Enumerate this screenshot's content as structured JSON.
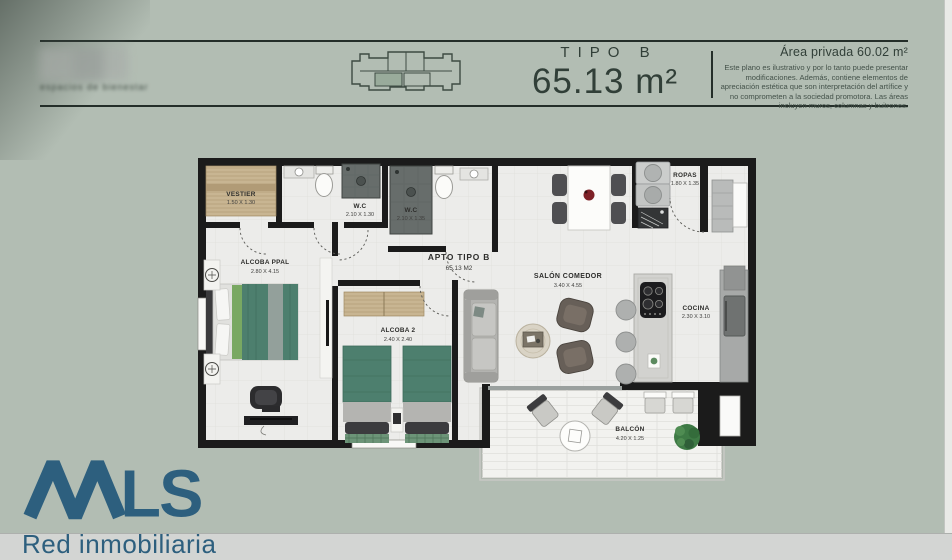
{
  "colors": {
    "background": "#b2bdb3",
    "wall": "#1b1b1b",
    "brand_blue": "#2d5f7e",
    "furniture_teal": "#4d7f6e",
    "header_text": "#313f38"
  },
  "header": {
    "project_tagline": "espacios de bienestar",
    "type_label": "TIPO B",
    "area_value": "65.13 m²",
    "private_area": "Área privada 60.02 m²",
    "disclaimer": "Este plano es ilustrativo y por lo tanto puede presentar modificaciones. Además, contiene elementos de apreciación estética que son interpretación del artífice y no comprometen a la sociedad promotora. Las áreas incluyen muros, columnas y buitrones."
  },
  "plan": {
    "unit_name": "APTO TIPO B",
    "unit_area": "65.13 M2",
    "rooms": {
      "vestier": {
        "name": "VESTIER",
        "dims": "1.50 X 1.30"
      },
      "wc1": {
        "name": "W.C",
        "dims": "2.10 X 1.30"
      },
      "wc2": {
        "name": "W.C",
        "dims": "2.10 X 1.35"
      },
      "alcoba_ppal": {
        "name": "ALCOBA PPAL",
        "dims": "2.80 X 4.15"
      },
      "alcoba2": {
        "name": "ALCOBA 2",
        "dims": "2.40 X 2.40"
      },
      "salon": {
        "name": "SALÓN COMEDOR",
        "dims": "3.40 X 4.55"
      },
      "ropas": {
        "name": "ROPAS",
        "dims": "1.80 X 1.35"
      },
      "cocina": {
        "name": "COCINA",
        "dims": "2.30 X 3.10"
      },
      "balcon": {
        "name": "BALCÓN",
        "dims": "4.20 X 1.25"
      }
    }
  },
  "footer": {
    "brand": "MLS",
    "brand_ls": "LS",
    "tagline": "Red inmobiliaria"
  }
}
